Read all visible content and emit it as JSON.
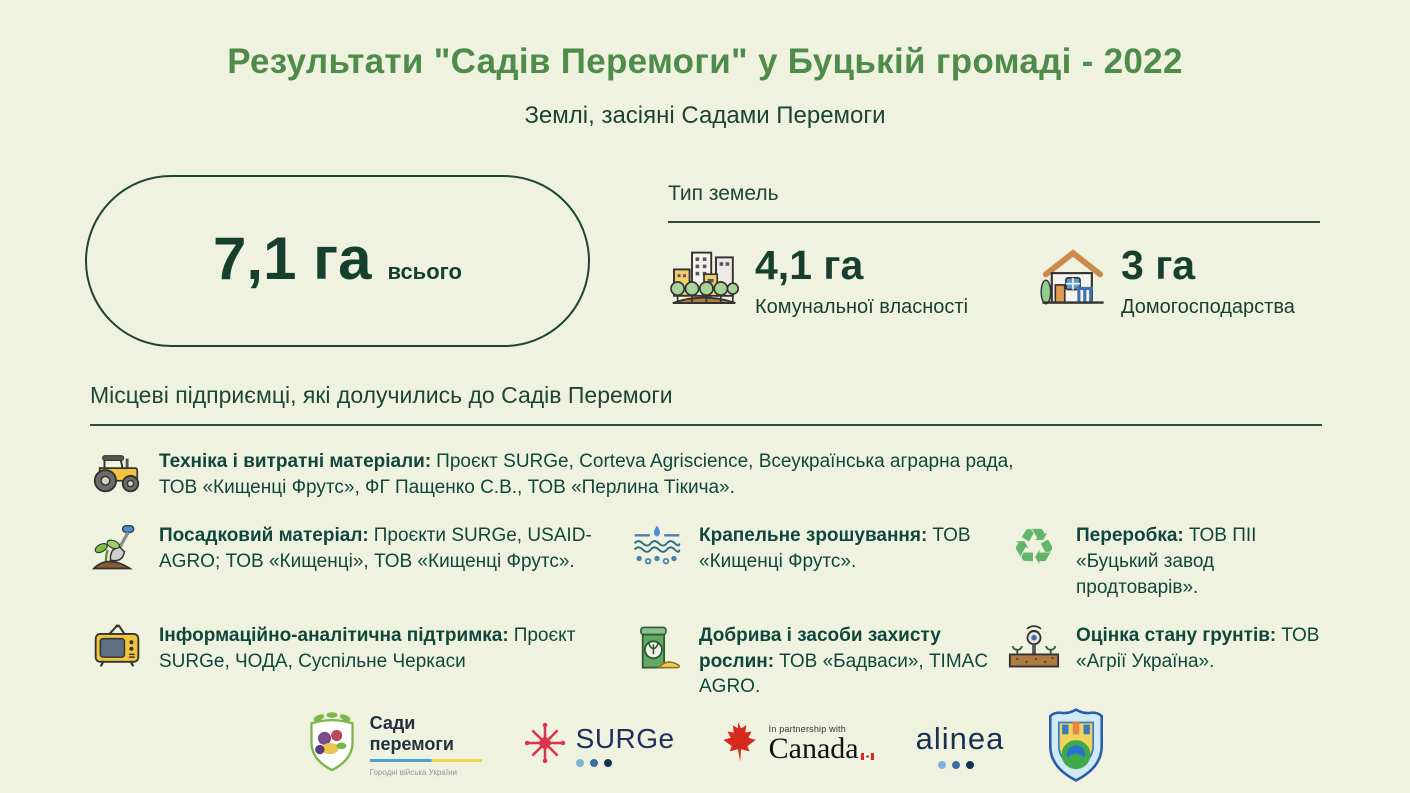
{
  "page": {
    "title": "Результати \"Садів Перемоги\" у Буцькій громаді - 2022",
    "subtitle": "Землі, засіяні Садами Перемоги"
  },
  "summary": {
    "total_value": "7,1 га",
    "total_label": "всього"
  },
  "land_types": {
    "heading": "Тип земель",
    "items": [
      {
        "icon": "city-trees-icon",
        "value": "4,1 га",
        "label": "Комунальної власності"
      },
      {
        "icon": "house-icon",
        "value": "3 га",
        "label": "Домогосподарства"
      }
    ]
  },
  "partners": {
    "heading": "Місцеві підприємці, які долучились до Садів Перемоги",
    "items": [
      {
        "icon": "tractor-icon",
        "title": "Техніка і витратні матеріали:",
        "text": "Проєкт SURGe, Corteva Agriscience, Всеукраїнська аграрна рада, ТОВ «Кищенці Фрутс», ФГ Пащенко С.В., ТОВ «Перлина Тікича»."
      },
      {
        "icon": "seedling-shovel-icon",
        "title": "Посадковий матеріал:",
        "text": "Проєкти SURGe, USAID-AGRO; ТОВ «Кищенці», ТОВ «Кищенці Фрутс»."
      },
      {
        "icon": "drip-irrigation-icon",
        "title": "Крапельне зрошування:",
        "text": "ТОВ «Кищенці Фрутс»."
      },
      {
        "icon": "recycle-icon",
        "title": "Переробка:",
        "text": "ТОВ ПІІ «Буцький завод продтоварів»."
      },
      {
        "icon": "tv-icon",
        "title": "Інформаційно-аналітична підтримка:",
        "text": "Проєкт SURGe, ЧОДА, Суспільне Черкаси"
      },
      {
        "icon": "fertilizer-bag-icon",
        "title": "Добрива і засоби захисту рослин:",
        "text": "ТОВ «Бадваси», TIMAC AGRO."
      },
      {
        "icon": "soil-sensor-icon",
        "title": "Оцінка стану грунтів:",
        "text": "ТОВ «Агрії Україна»."
      }
    ]
  },
  "icons": {
    "recycle_glyph": "♻"
  },
  "footer": {
    "sady": {
      "line1": "Сади",
      "line2": "перемоги",
      "tagline": "Городні війська України"
    },
    "surge": {
      "text": "SURGe"
    },
    "canada": {
      "partnership": "In partnership with",
      "wordmark": "Canada"
    },
    "alinea": {
      "text": "alinea"
    }
  },
  "colors": {
    "background": "#f0f2e0",
    "title_green": "#4f8b4b",
    "dark_green": "#173f2e",
    "body_green": "#10473c",
    "line": "#2c4c3c"
  }
}
